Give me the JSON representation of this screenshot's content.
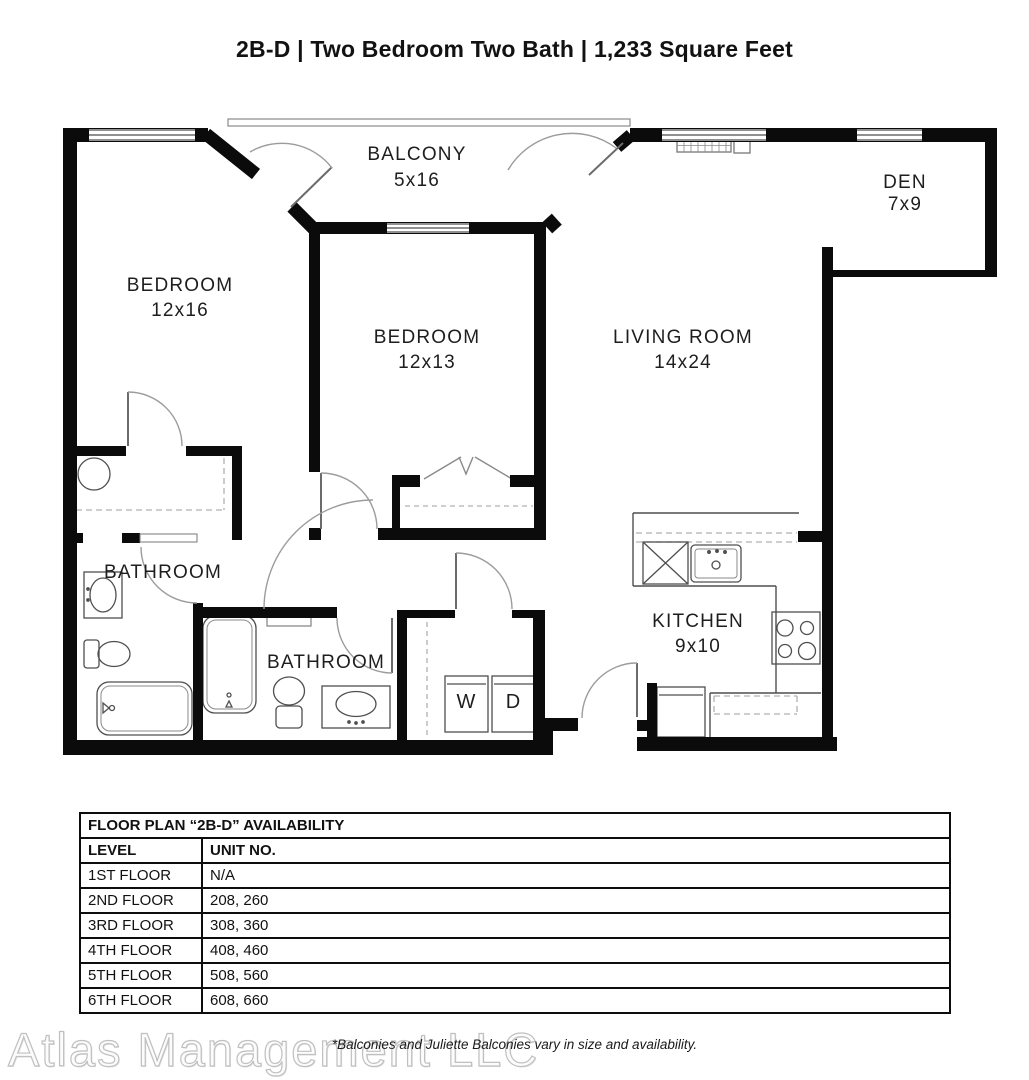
{
  "page": {
    "title": "2B-D | Two Bedroom Two Bath | 1,233 Square Feet"
  },
  "floor_plan": {
    "rooms": {
      "balcony": {
        "name": "BALCONY",
        "dims": "5x16"
      },
      "den": {
        "name": "DEN",
        "dims": "7x9"
      },
      "bedroom1": {
        "name": "BEDROOM",
        "dims": "12x16"
      },
      "bedroom2": {
        "name": "BEDROOM",
        "dims": "12x13"
      },
      "living": {
        "name": "LIVING ROOM",
        "dims": "14x24"
      },
      "kitchen": {
        "name": "KITCHEN",
        "dims": "9x10"
      },
      "bathroom1": {
        "name": "BATHROOM"
      },
      "bathroom2": {
        "name": "BATHROOM"
      },
      "washer": "W",
      "dryer": "D"
    },
    "colors": {
      "wall": "#0b0b0b",
      "fixture_line": "#4f4f4f",
      "door_arc": "#9c9c9c",
      "dashed_line": "#b0b0b0"
    }
  },
  "availability_table": {
    "title": "FLOOR PLAN “2B-D” AVAILABILITY",
    "columns": [
      "LEVEL",
      "UNIT NO."
    ],
    "rows": [
      [
        "1ST FLOOR",
        "N/A"
      ],
      [
        "2ND FLOOR",
        "208, 260"
      ],
      [
        "3RD FLOOR",
        "308, 360"
      ],
      [
        "4TH FLOOR",
        "408, 460"
      ],
      [
        "5TH FLOOR",
        "508, 560"
      ],
      [
        "6TH FLOOR",
        "608, 660"
      ]
    ]
  },
  "footnote": "*Balconies and Juliette Balconies vary in size and availability.",
  "watermark": "Atlas Management LLC"
}
